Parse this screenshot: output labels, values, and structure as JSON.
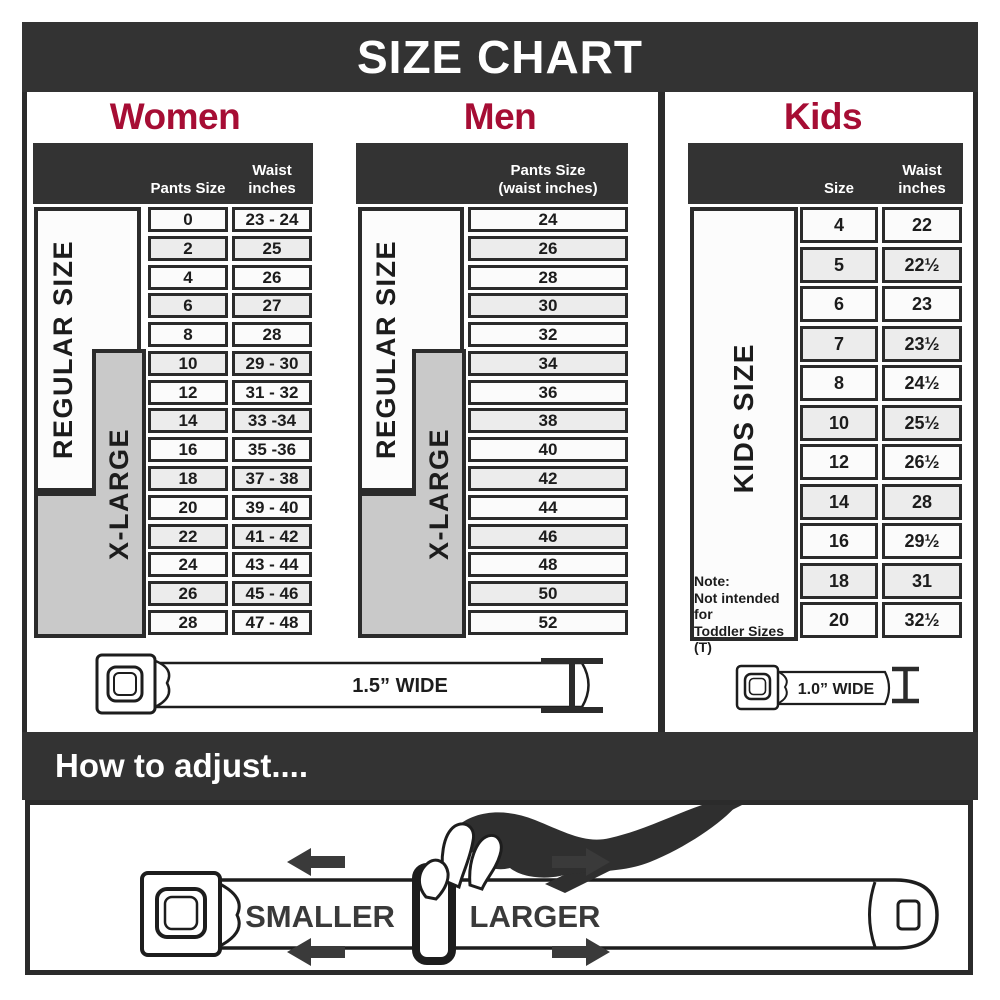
{
  "title": "SIZE CHART",
  "colors": {
    "banner": "#333333",
    "accent": "#a60d34",
    "grid": "#2b2b2b",
    "xlarge_fill": "#c9c9c9"
  },
  "women": {
    "label": "Women",
    "regular_label": "REGULAR SIZE",
    "xlarge_label": "X-LARGE",
    "col1": "Pants Size",
    "col2": "Waist\ninches",
    "rows": [
      [
        "0",
        "23 - 24"
      ],
      [
        "2",
        "25"
      ],
      [
        "4",
        "26"
      ],
      [
        "6",
        "27"
      ],
      [
        "8",
        "28"
      ],
      [
        "10",
        "29 - 30"
      ],
      [
        "12",
        "31 - 32"
      ],
      [
        "14",
        "33 -34"
      ],
      [
        "16",
        "35 -36"
      ],
      [
        "18",
        "37 - 38"
      ],
      [
        "20",
        "39 - 40"
      ],
      [
        "22",
        "41 - 42"
      ],
      [
        "24",
        "43 - 44"
      ],
      [
        "26",
        "45 - 46"
      ],
      [
        "28",
        "47 - 48"
      ]
    ]
  },
  "men": {
    "label": "Men",
    "regular_label": "REGULAR SIZE",
    "xlarge_label": "X-LARGE",
    "col1": "Pants Size\n(waist inches)",
    "rows": [
      "24",
      "26",
      "28",
      "30",
      "32",
      "34",
      "36",
      "38",
      "40",
      "42",
      "44",
      "46",
      "48",
      "50",
      "52"
    ]
  },
  "kids": {
    "label": "Kids",
    "size_label": "KIDS SIZE",
    "col1": "Size",
    "col2": "Waist\ninches",
    "rows": [
      [
        "4",
        "22"
      ],
      [
        "5",
        "22½"
      ],
      [
        "6",
        "23"
      ],
      [
        "7",
        "23½"
      ],
      [
        "8",
        "24½"
      ],
      [
        "10",
        "25½"
      ],
      [
        "12",
        "26½"
      ],
      [
        "14",
        "28"
      ],
      [
        "16",
        "29½"
      ],
      [
        "18",
        "31"
      ],
      [
        "20",
        "32½"
      ]
    ],
    "note_lines": [
      "Note:",
      "Not intended for",
      "Toddler Sizes (T)"
    ]
  },
  "belts": {
    "adult_width_label": "1.5” WIDE",
    "kids_width_label": "1.0” WIDE"
  },
  "adjust": {
    "title": "How to adjust....",
    "smaller": "SMALLER",
    "larger": "LARGER"
  }
}
